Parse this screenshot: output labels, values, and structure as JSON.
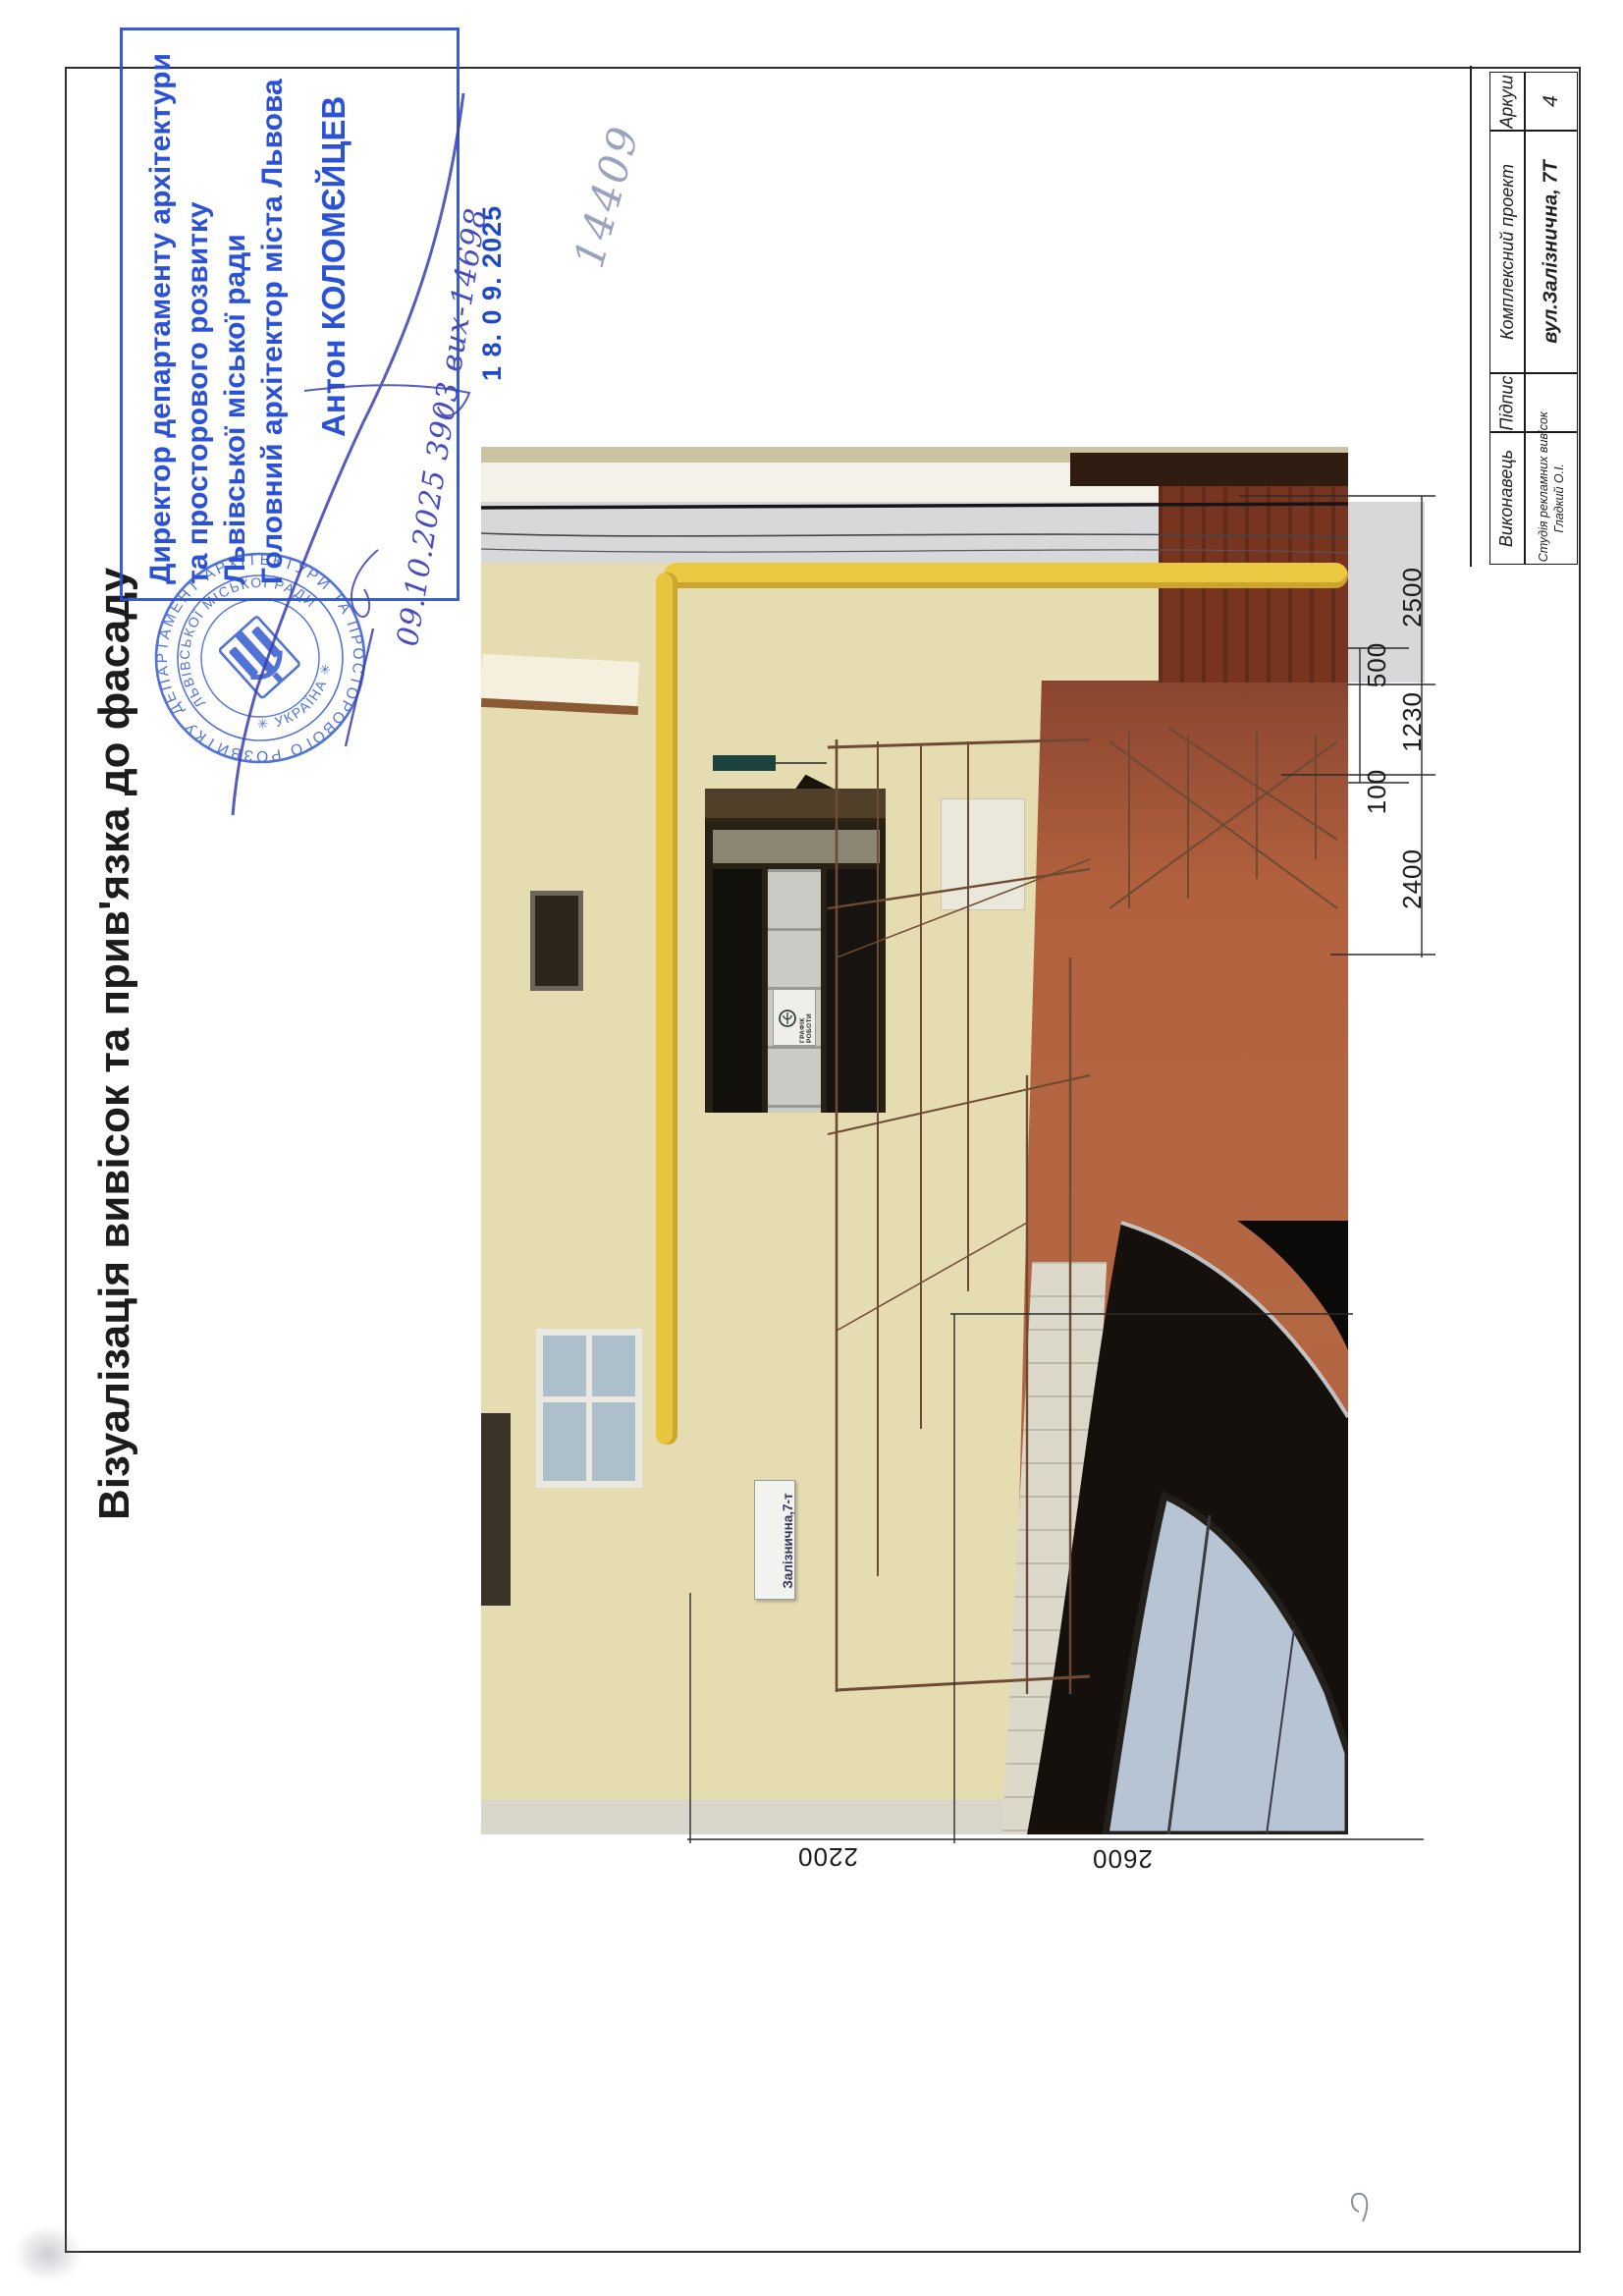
{
  "document": {
    "title": "Візуалізація вивісок та прив'язка до фасаду",
    "handwritten_number": "14409",
    "handwritten_note": "09.10.2025 3903 вих-14698",
    "date_stamp": "1 8. 0 9. 2025",
    "ink_blue": "#2b51d6"
  },
  "approval_stamp": {
    "line1": "Директор департаменту архітектури",
    "line2": "та просторового розвитку",
    "line3": "Львівської міської ради",
    "line4": "Головний архітектор міста Львова",
    "signer_name": "Антон КОЛОМЄЙЦЕВ"
  },
  "official_seal": {
    "outer_text": "ДЕПАРТАМЕНТ АРХІТЕКТУРИ ТА ПРОСТОРОВОГО РОЗВИТКУ",
    "inner_text": "ЛЬВІВСЬКОЇ МІСЬКОЇ РАДИ",
    "bottom_text": "✳ УКРАЇНА ✳"
  },
  "photo": {
    "address_plate_text": "Залізнична,7-т",
    "schedule_sign_text": "ГРАФІК РОБОТИ"
  },
  "dimensions": {
    "right_chain": [
      "2500",
      "500",
      "1230",
      "100",
      "2400"
    ],
    "bottom_chain": [
      "2200",
      "2600"
    ]
  },
  "title_block": {
    "sheet_label": "Аркуш",
    "sheet_value": "4",
    "project_label": "Комплексний проект",
    "project_value": "вул.Залізнична, 7Т",
    "signature_label": "Підпис",
    "executor_label": "Виконавець",
    "executor_value_line1": "Студія рекламних вивісок",
    "executor_value_line2": "Гладкий О.І."
  }
}
